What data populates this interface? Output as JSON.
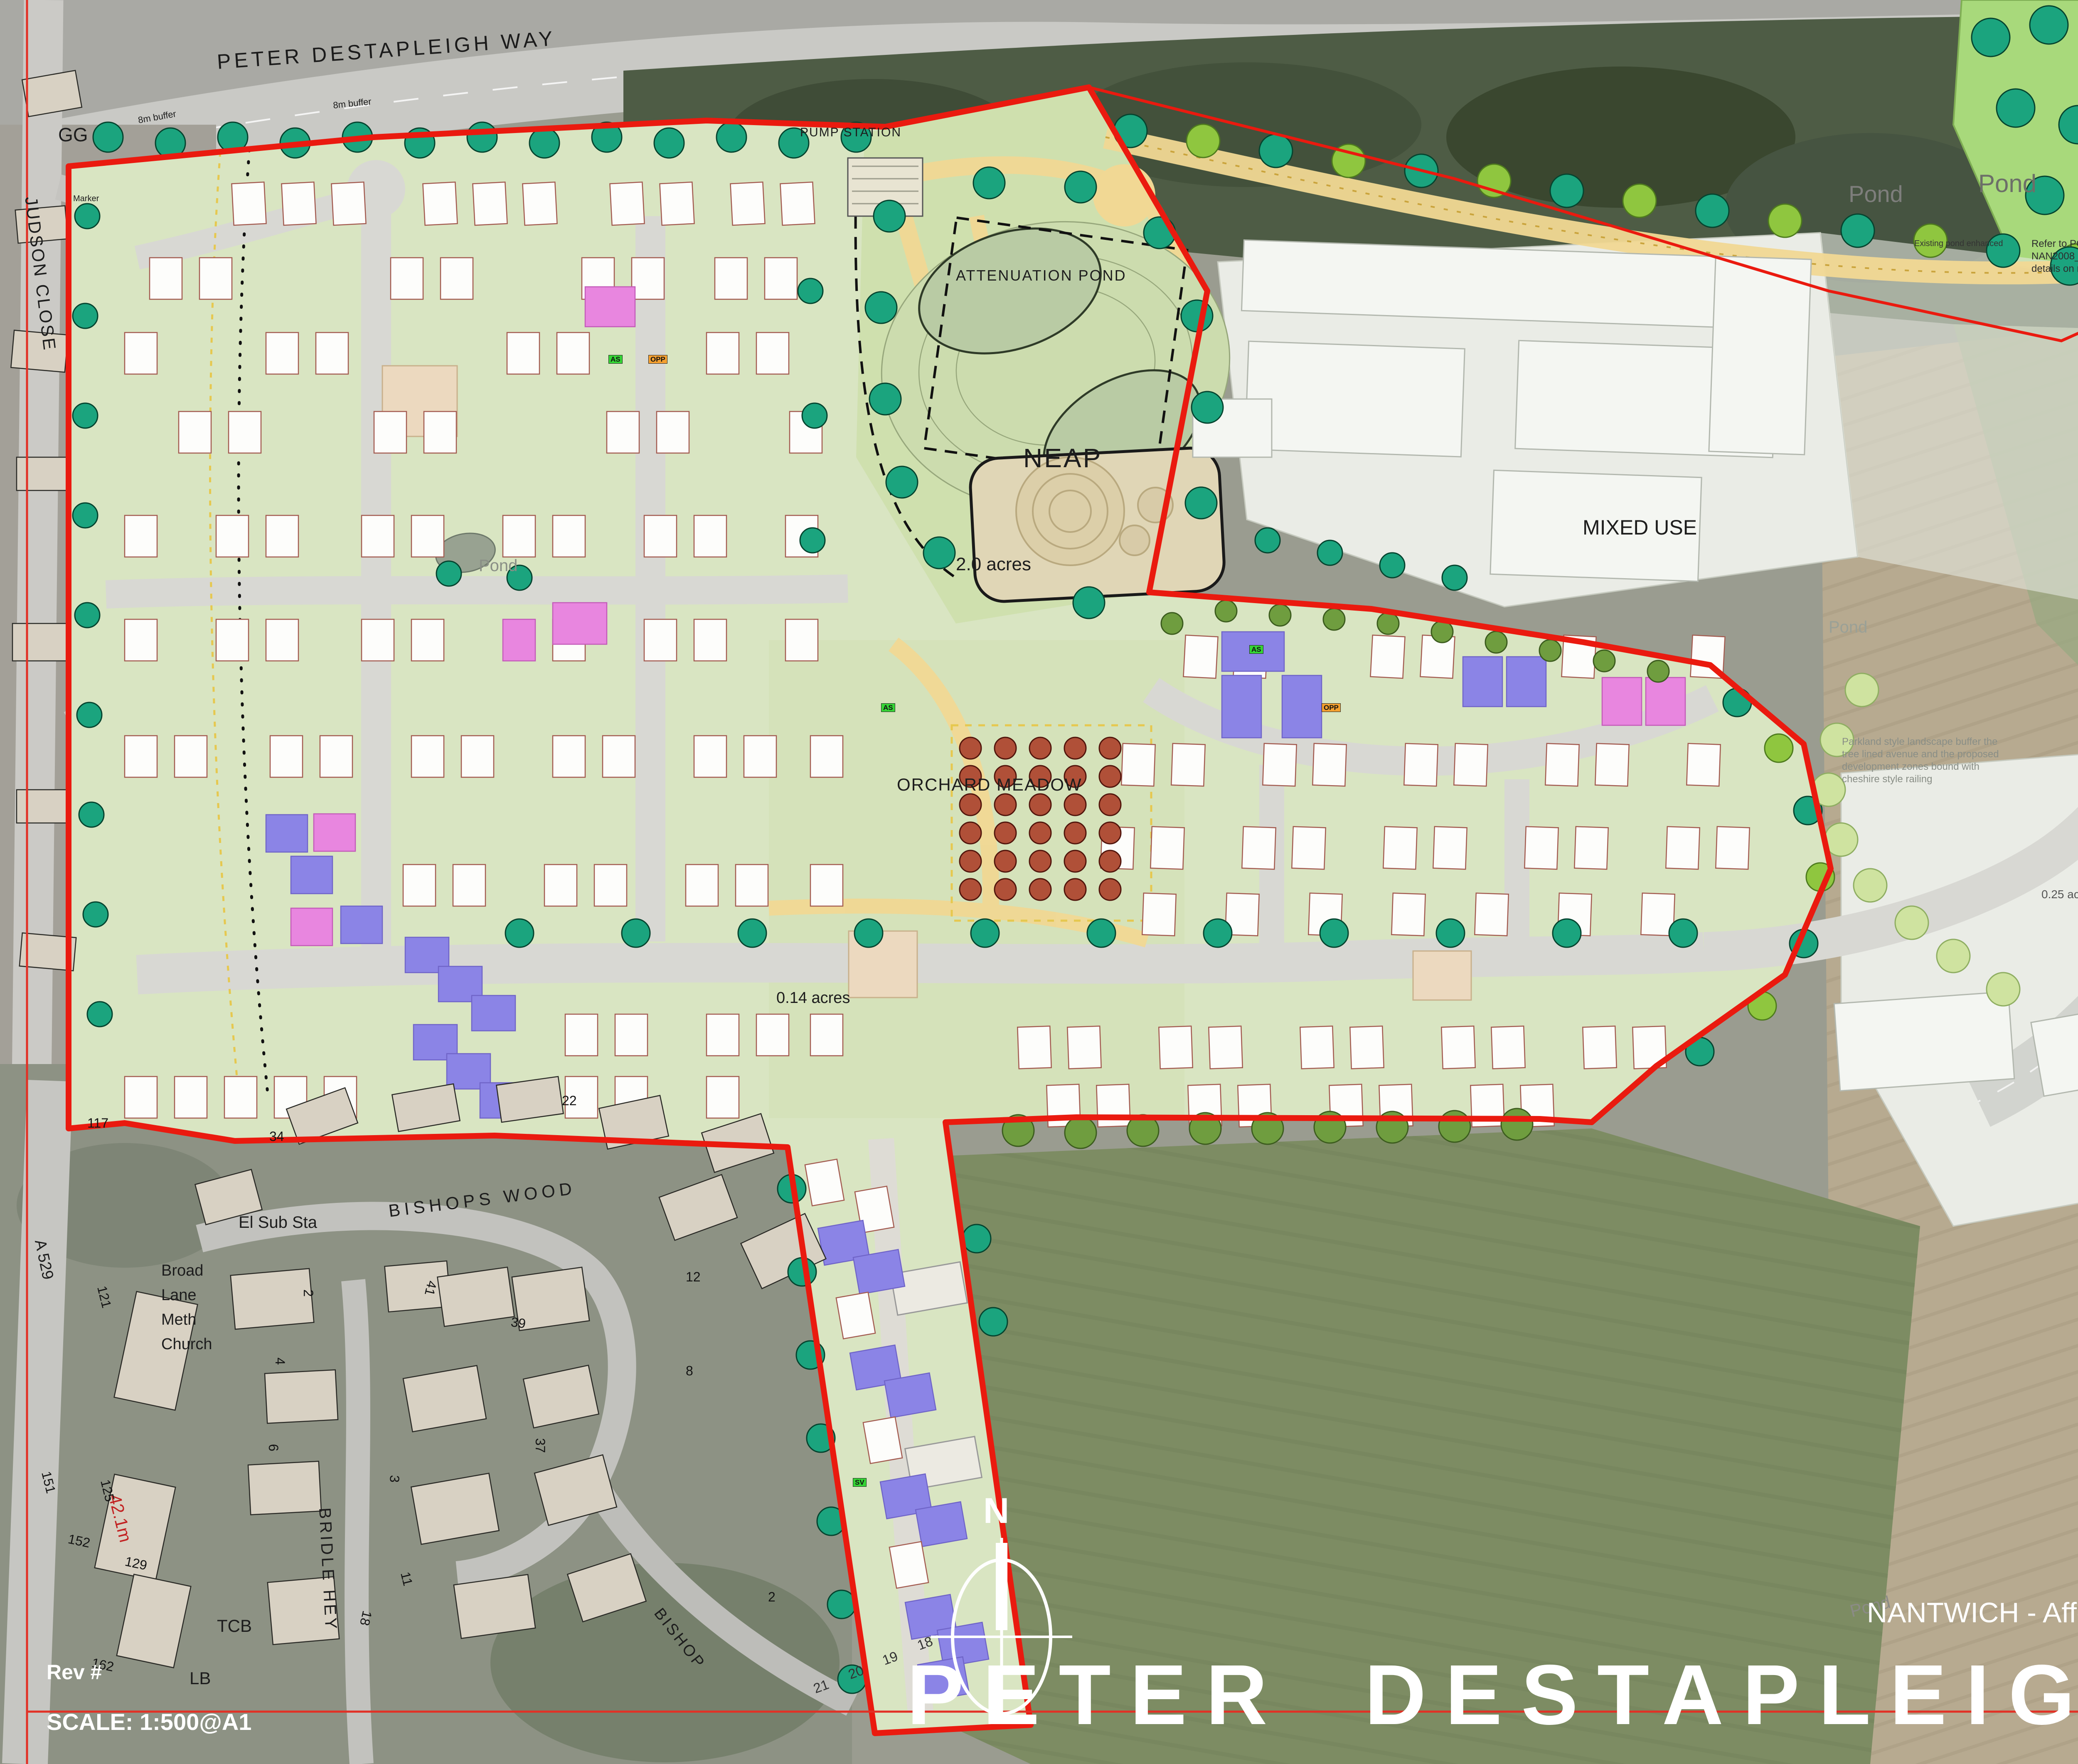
{
  "page": {
    "rev": "Rev #",
    "scale": "SCALE: 1:500@A1",
    "subtitle": "NANTWICH - Affordable Housing Plan",
    "title": "PETER DESTAPLEIGH WAY"
  },
  "legend": {
    "title": "Key:",
    "items": [
      {
        "label": "Development Boundary",
        "color": "#ea1a0f"
      },
      {
        "label": "Affordable Rented Units",
        "color": "#8b84e6"
      },
      {
        "label": "Affordable Shared Equity Units",
        "color": "#e886df"
      }
    ]
  },
  "affordable_table": {
    "section_title": "Affordable",
    "columns": [
      "House Type Code",
      "",
      "Beds",
      "Storey Height",
      "Number",
      "Sq Ft",
      "Total Sq Ft"
    ],
    "rows": [
      [
        "TYPE R",
        "",
        "1",
        "2",
        "3",
        "565",
        "1695"
      ],
      [
        "TYPE S",
        "",
        "3",
        "2",
        "3",
        "862",
        "2586"
      ],
      [
        "TYPE T",
        "",
        "1",
        "2",
        "4",
        "455",
        "1820"
      ],
      [
        "TYPE U",
        "",
        "2",
        "2",
        "4",
        "643",
        "2572"
      ],
      [
        "TYPE V (MID)",
        "NDSS",
        "2",
        "2",
        "10",
        "750",
        "7500"
      ],
      [
        "TYPE V (END)",
        "NDSS",
        "2",
        "2",
        "8",
        "750",
        "6000"
      ],
      [
        "TYPE W (MID)",
        "NDSS",
        "3",
        "2",
        "9",
        "930",
        "8370"
      ],
      [
        "TYPE W (END)",
        "NDSS",
        "3",
        "2",
        "13",
        "930",
        "12090"
      ],
      [
        "TYPE X",
        "NDSS",
        "4",
        "2",
        "2",
        "1104",
        "2208"
      ],
      [
        "TYPE Y",
        "NDSS",
        "3",
        "2",
        "1",
        "958",
        "958"
      ]
    ]
  },
  "summary_table": {
    "title": "Affordable Summary",
    "subtitle": "Bedroom Provision",
    "rows": [
      [
        "1 Beds:",
        "7",
        "12.3%"
      ],
      [
        "2 Beds:",
        "22",
        "38.6%"
      ],
      [
        "3 Beds:",
        "26",
        "45.6%"
      ],
      [
        "4 Beds:",
        "2",
        "3.5%"
      ]
    ],
    "ndss": [
      "NDSS",
      "43",
      "75.4%"
    ],
    "totals": [
      [
        "Total Dwellings:",
        "57"
      ],
      [
        "Provision Percentage;",
        "30.2%"
      ],
      [
        "Total Sq Ft:",
        "45799"
      ]
    ]
  },
  "labels": {
    "road_top": "PETER DESTAPLEIGH WAY",
    "gg": "GG",
    "marker": "Marker",
    "judson_close": "JUDSON CLOSE",
    "buffer_a": "8m buffer",
    "buffer_b": "8m buffer",
    "pump_station": "PUMP STATION",
    "attenuation_pond": "ATTENUATION POND",
    "neap": "NEAP",
    "acres_2": "2.0 acres",
    "orchard_meadow": "ORCHARD MEADOW",
    "mixed_use_1": "MIXED USE",
    "mixed_use_2": "MIXED USE",
    "pond_a": "Pond",
    "pond_b": "Pond",
    "pond_c": "Pond",
    "pond_d": "Pond",
    "pond_e": "Pond",
    "pond_f": "Pond",
    "existing_pond": "Existing pond enhanced",
    "note_pgla": "Refer to PGLA Drawings\nNAN2008_PP01.00 series for landscape\ndetails on road section A to B",
    "note_parkland": "Parkland style landscape buffer the\ntree lined avenue and the proposed\ndevelopment zones bound with\ncheshire style railing",
    "acres_02": "0.2 ac",
    "acres_025": "0.25 acres",
    "acres_014": "0.14 acres",
    "el_sub_sta": "El Sub Sta",
    "bishops_wood": "BISHOPS  WOOD",
    "broad_lane": "Broad\nLane\nMeth\nChurch",
    "bridle_hey": "BRIDLE  HEY",
    "a529": "A 529",
    "dist_42": "42.1m",
    "tcb": "TCB",
    "lb": "LB",
    "bishop_road": "BISHOP"
  },
  "house_numbers": {
    "h117": "117",
    "h121": "121",
    "h125": "125",
    "h129": "129",
    "h151": "151",
    "h152": "152",
    "h162": "162",
    "h34": "34",
    "h22": "22",
    "h12": "12",
    "h8": "8",
    "h2": "2",
    "h4": "4",
    "h6": "6",
    "h41": "41",
    "h39": "39",
    "h37": "37",
    "h3": "3",
    "h18": "18",
    "h11": "11",
    "h2leg": "2"
  },
  "plots": {
    "p18": "18",
    "p19": "19",
    "p20": "20",
    "p21": "21"
  },
  "tags": {
    "as": "AS",
    "opp": "OPP",
    "sv": "SV"
  },
  "compass": {
    "north": "N"
  }
}
